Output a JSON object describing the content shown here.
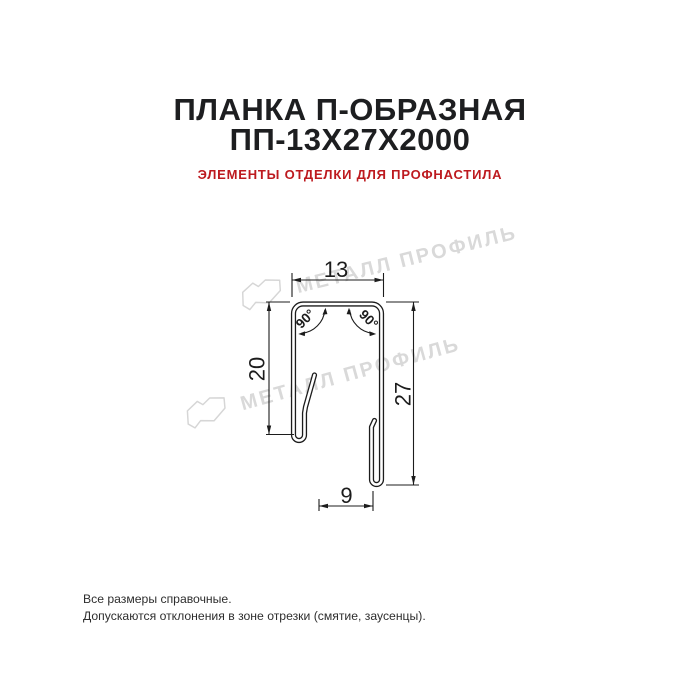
{
  "header": {
    "title_line1": "ПЛАНКА П-ОБРАЗНАЯ",
    "title_line2": "ПП-13Х27Х2000",
    "subtitle": "ЭЛЕМЕНТЫ ОТДЕЛКИ ДЛЯ ПРОФНАСТИЛА"
  },
  "watermark": {
    "brand_text": "МЕТАЛЛ ПРОФИЛЬ",
    "color": "#d9d9d9",
    "logo_icon": "metall-profil-sheet-logo"
  },
  "drawing": {
    "dimensions": {
      "top_width_mm": "13",
      "left_height_mm": "20",
      "right_height_mm": "27",
      "bottom_width_mm": "9",
      "angle_top_left": "90°",
      "angle_top_right": "90°"
    },
    "line_color": "#1c1c1c"
  },
  "footer": {
    "line1": "Все размеры справочные.",
    "line2": "Допускаются отклонения в зоне отрезки (смятие, заусенцы)."
  },
  "colors": {
    "background": "#ffffff",
    "title": "#1d1e20",
    "subtitle_red": "#bd1a1f",
    "watermark_gray": "#d9d9d9"
  }
}
